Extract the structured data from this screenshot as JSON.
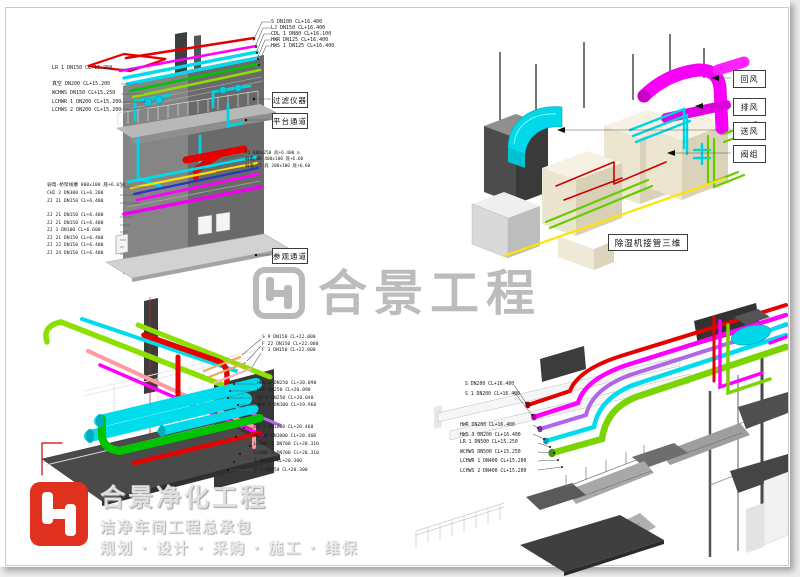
{
  "watermark": {
    "text": "合景工程",
    "color": "#b9b9b9"
  },
  "brand": {
    "title": "合景净化工程",
    "subtitle": "洁净车间工程总承包",
    "services": "规划 · 设计 · 采购 · 施工 · 维保",
    "logo_color": "#e0301e"
  },
  "views": {
    "building": {
      "labels_top_right": [
        "S DN100 CL+16.400",
        "LJ DN150 CL+16.400",
        "CDL 1 DN80 CL+16.100",
        "HWR DN125 CL+16.400",
        "HWS 1 DN125 CL+16.400"
      ],
      "labels_left_upper": [
        "LR 1 DN150 CL+15.250",
        "真空 DN200 CL+15.200",
        "WCHWS DN150 CL+15.250",
        "LCHWR 1 DN200 CL+15.200",
        "LCHWS 2 DN200 CL+15.200"
      ],
      "labels_left_lower": [
        "弱电-桥架线槽 800x100 底+6.650",
        "CHI 2 DN300 CL+6.200",
        "ZJ 21 DN150 CL+6.400",
        "ZJ 21 DN150 CL+6.400",
        "ZJ 21 DN150 CL+6.400",
        "ZJ 1 DN100 CL+6.600",
        "ZJ 21 DN150 CL+6.400",
        "ZJ 22 DN150 CL+6.400",
        "ZJ 24 DN150 CL+6.400"
      ],
      "labels_mid_right": [
        "P1 800x250 底+6.400 a",
        "弱电_BR 400x100 底+6.60",
        "弱电-C7 底 200x100 底+6.60"
      ],
      "callouts": [
        "过滤仪器",
        "平台通道",
        "参观通道"
      ]
    },
    "dehumidifier": {
      "title": "除湿机接管三维",
      "callouts": [
        "回风",
        "排风",
        "送风",
        "阀组"
      ]
    },
    "pumproom": {
      "labels_group1": [
        "S 9 DN150 CL+22.000",
        "F 22 DN150 CL+22.000",
        "F 3 DN150 CL+22.000"
      ],
      "labels_group2": [
        "HWS 3 DN250 CL+20.090",
        "HWR DN250 CL+20.090",
        "CW 1 DN250 CL+20.040",
        "WWP 1 DN100 CL+19.960"
      ],
      "labels_group3": [
        "LR 1 DN1000 CL+20.460",
        "WCHWS DN1000 CL+20.460",
        "LCHWR 1 DN700 CL+20.310",
        "LCHWS 2 DN700 CL+20.310",
        "S DN350 CL+20.300",
        "S 1 DN250 CL+20.300"
      ]
    },
    "stairwell": {
      "labels_group1": [
        "S DN200 CL+16.400",
        "S 1 DN200 CL+16.400"
      ],
      "labels_group2": [
        "HWR DN200 CL+16.400",
        "HWS 3 DN200 CL+16.400"
      ],
      "labels_group3": [
        "LR 1 DN500 CL+15.250",
        "WCHWS DN500 CL+15.250",
        "LCHWR 1 DN400 CL+15.200",
        "LCHWS 2 DN400 CL+15.200"
      ]
    }
  },
  "colors": {
    "pipe_red": "#e60000",
    "pipe_magenta": "#ff00ff",
    "pipe_cyan": "#00dcec",
    "pipe_green": "#00c400",
    "pipe_chartreuse": "#8ce000",
    "pipe_yellow": "#ffdf00",
    "pipe_blue": "#2b35c8",
    "pipe_pink": "#ff9aa0",
    "pipe_violet": "#b866f0",
    "pipe_orange": "#f0a860",
    "structure_gray": "#6a6a6a",
    "unit_beige": "#ece5d0"
  }
}
